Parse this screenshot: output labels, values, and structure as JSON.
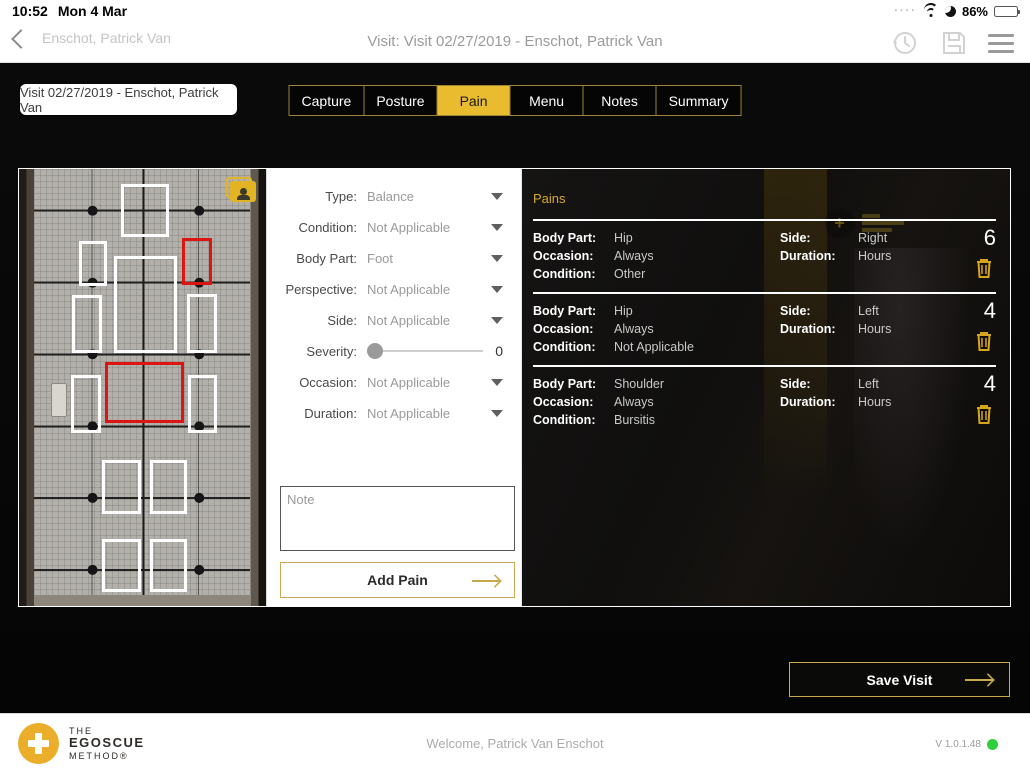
{
  "status_bar": {
    "time": "10:52",
    "date": "Mon 4 Mar",
    "signal_dots": "····",
    "battery_percent": "86%"
  },
  "nav": {
    "back_label": "Enschot, Patrick Van",
    "title": "Visit: Visit 02/27/2019 - Enschot, Patrick Van"
  },
  "visit_chip": {
    "label": "Visit 02/27/2019 - Enschot, Patrick Van"
  },
  "tabs": {
    "items": [
      {
        "label": "Capture",
        "active": false
      },
      {
        "label": "Posture",
        "active": false
      },
      {
        "label": "Pain",
        "active": true
      },
      {
        "label": "Menu",
        "active": false
      },
      {
        "label": "Notes",
        "active": false
      },
      {
        "label": "Summary",
        "active": false
      }
    ]
  },
  "pain_form": {
    "fields": [
      {
        "label": "Type:",
        "value": "Balance"
      },
      {
        "label": "Condition:",
        "value": "Not Applicable"
      },
      {
        "label": "Body Part:",
        "value": "Foot"
      },
      {
        "label": "Perspective:",
        "value": "Not Applicable"
      },
      {
        "label": "Side:",
        "value": "Not Applicable"
      }
    ],
    "severity": {
      "label": "Severity:",
      "value": "0"
    },
    "fields2": [
      {
        "label": "Occasion:",
        "value": "Not Applicable"
      },
      {
        "label": "Duration:",
        "value": "Not Applicable"
      }
    ],
    "note_placeholder": "Note",
    "add_button": "Add Pain"
  },
  "pains_panel": {
    "title": "Pains",
    "labels": {
      "body_part": "Body Part:",
      "side": "Side:",
      "occasion": "Occasion:",
      "duration": "Duration:",
      "condition": "Condition:"
    },
    "entries": [
      {
        "body_part": "Hip",
        "side": "Right",
        "occasion": "Always",
        "duration": "Hours",
        "condition": "Other",
        "severity": "6"
      },
      {
        "body_part": "Hip",
        "side": "Left",
        "occasion": "Always",
        "duration": "Hours",
        "condition": "Not Applicable",
        "severity": "4"
      },
      {
        "body_part": "Shoulder",
        "side": "Left",
        "occasion": "Always",
        "duration": "Hours",
        "condition": "Bursitis",
        "severity": "4"
      }
    ]
  },
  "save_button": {
    "label": "Save Visit"
  },
  "footer": {
    "brand_line1": "THE",
    "brand_line2": "EGOSCUE",
    "brand_line3": "METHOD®",
    "welcome": "Welcome, Patrick Van Enschot",
    "version": "V 1.0.1.48"
  },
  "posture_overlay": {
    "zones": [
      {
        "name": "head",
        "x": 41.3,
        "y": 3.4,
        "w": 19.4,
        "h": 12.1,
        "flagged": false
      },
      {
        "name": "shoulder-right",
        "x": 24.3,
        "y": 16.4,
        "w": 11.3,
        "h": 10.3,
        "flagged": false
      },
      {
        "name": "shoulder-left",
        "x": 66.0,
        "y": 15.9,
        "w": 12.1,
        "h": 10.7,
        "flagged": true
      },
      {
        "name": "torso",
        "x": 38.5,
        "y": 20.0,
        "w": 25.5,
        "h": 22.1,
        "flagged": false
      },
      {
        "name": "arm-right",
        "x": 21.5,
        "y": 28.9,
        "w": 12.1,
        "h": 13.2,
        "flagged": false
      },
      {
        "name": "arm-left",
        "x": 68.0,
        "y": 28.7,
        "w": 12.1,
        "h": 13.4,
        "flagged": false
      },
      {
        "name": "hip-center",
        "x": 34.8,
        "y": 44.2,
        "w": 32.0,
        "h": 13.9,
        "flagged": true
      },
      {
        "name": "hip-right",
        "x": 21.1,
        "y": 47.2,
        "w": 12.1,
        "h": 13.2,
        "flagged": false
      },
      {
        "name": "hip-left",
        "x": 68.4,
        "y": 47.2,
        "w": 11.7,
        "h": 13.2,
        "flagged": false
      },
      {
        "name": "thigh-right",
        "x": 33.6,
        "y": 66.5,
        "w": 15.8,
        "h": 12.5,
        "flagged": false
      },
      {
        "name": "thigh-left",
        "x": 53.0,
        "y": 66.5,
        "w": 15.0,
        "h": 12.5,
        "flagged": false
      },
      {
        "name": "calf-right",
        "x": 33.6,
        "y": 84.7,
        "w": 15.8,
        "h": 12.1,
        "flagged": false
      },
      {
        "name": "calf-left",
        "x": 53.0,
        "y": 84.7,
        "w": 15.0,
        "h": 12.1,
        "flagged": false
      }
    ]
  },
  "colors": {
    "gold": "#E9BB2F",
    "flag_red": "#DB1512",
    "status_green": "#2ECE3C"
  }
}
